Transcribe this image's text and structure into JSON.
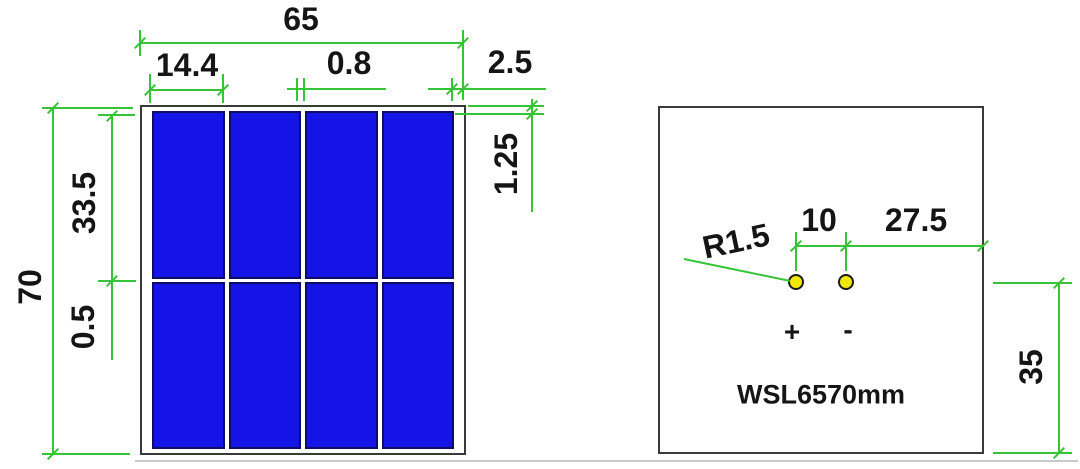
{
  "colors": {
    "dim_green": "#35c435",
    "cell_blue": "#1414e6",
    "cell_edge": "#0d0d66",
    "frame_gray": "#3a3a3a",
    "hole_yellow": "#f2e70a",
    "text_black": "#151515"
  },
  "front_view": {
    "columns": 4,
    "rows": 2,
    "overall_width": "65",
    "cell_width": "14.4",
    "cell_gap": "0.8",
    "edge_margin": "2.5",
    "overall_height": "70",
    "cell_height": "33.5",
    "row_gap": "0.5",
    "top_margin": "1.25"
  },
  "back_view": {
    "hole_radius": "R1.5",
    "hole_pitch": "10",
    "hole_to_edge": "27.5",
    "hole_to_bottom": "35",
    "positive_terminal": "+",
    "negative_terminal": "-",
    "model": "WSL6570mm"
  }
}
